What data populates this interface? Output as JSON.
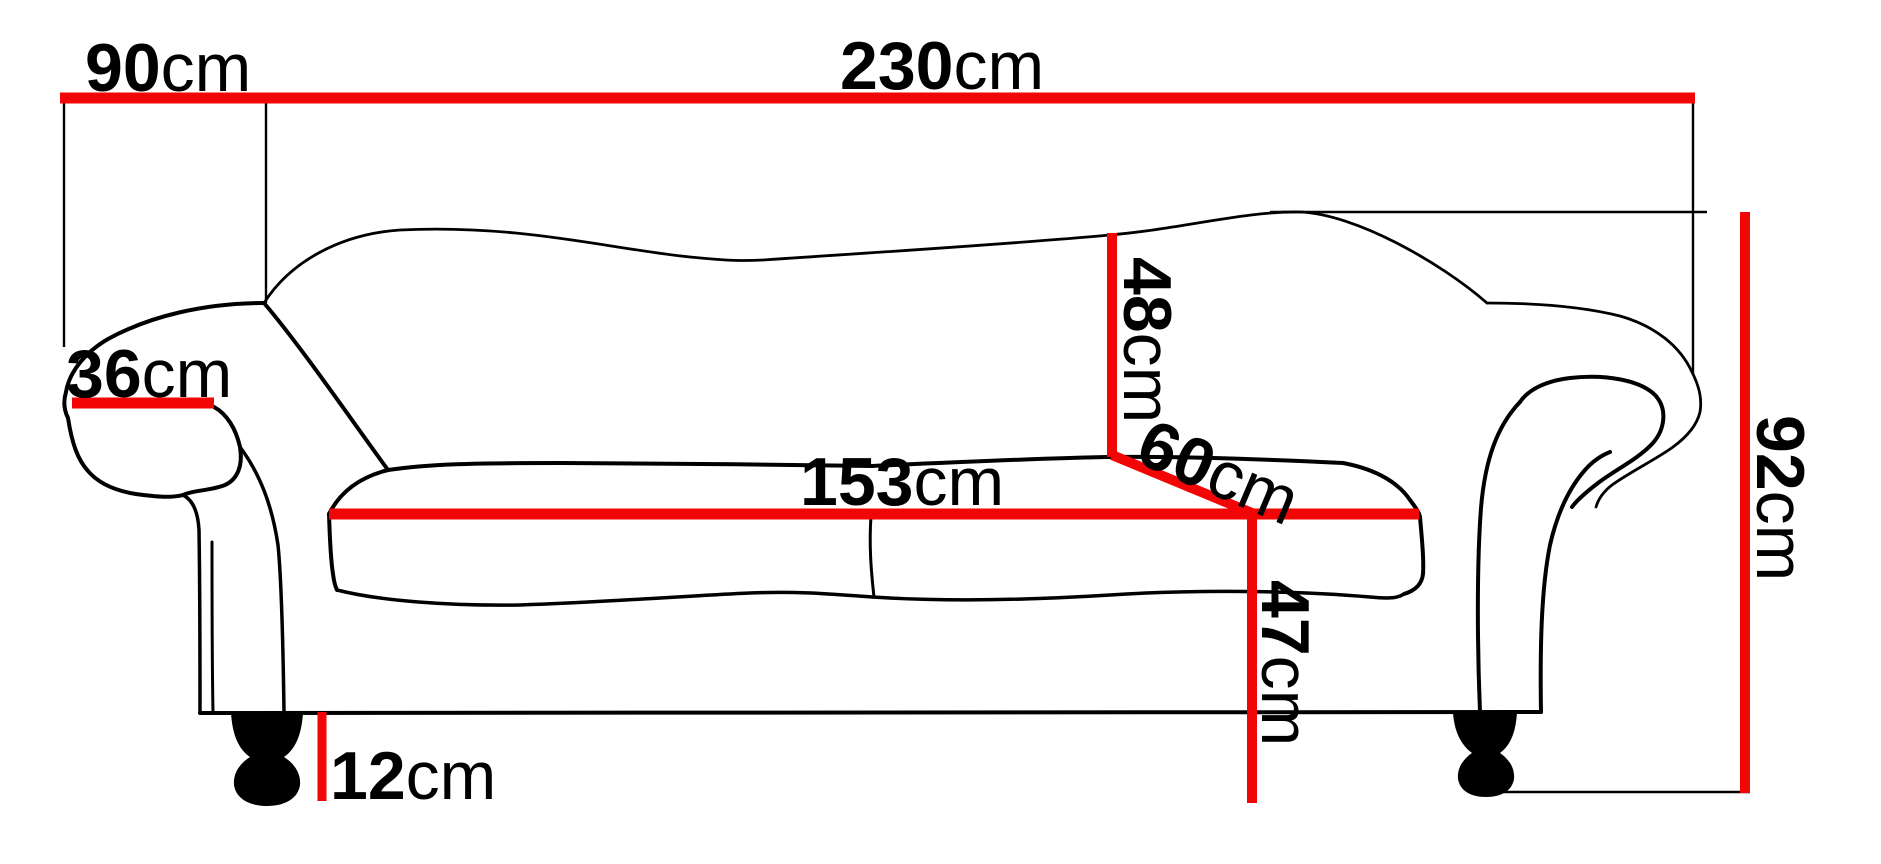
{
  "diagram": {
    "title": "sofa-dimension-diagram",
    "unit": "cm",
    "colors": {
      "dimension_line": "#f20505",
      "outline": "#000000",
      "background": "#ffffff"
    },
    "dimensions": {
      "total_width": {
        "num": "230",
        "unit": "cm",
        "orientation": "horizontal"
      },
      "depth": {
        "num": "90",
        "unit": "cm",
        "orientation": "horizontal"
      },
      "armrest_width": {
        "num": "36",
        "unit": "cm",
        "orientation": "horizontal"
      },
      "backrest_height": {
        "num": "48",
        "unit": "cm",
        "orientation": "vertical-rotated"
      },
      "seat_depth": {
        "num": "60",
        "unit": "cm",
        "orientation": "diagonal-rotated"
      },
      "seat_width": {
        "num": "153",
        "unit": "cm",
        "orientation": "horizontal"
      },
      "seat_height": {
        "num": "47",
        "unit": "cm",
        "orientation": "vertical-rotated"
      },
      "leg_height": {
        "num": "12",
        "unit": "cm",
        "orientation": "horizontal"
      },
      "total_height": {
        "num": "92",
        "unit": "cm",
        "orientation": "vertical-rotated"
      }
    }
  }
}
